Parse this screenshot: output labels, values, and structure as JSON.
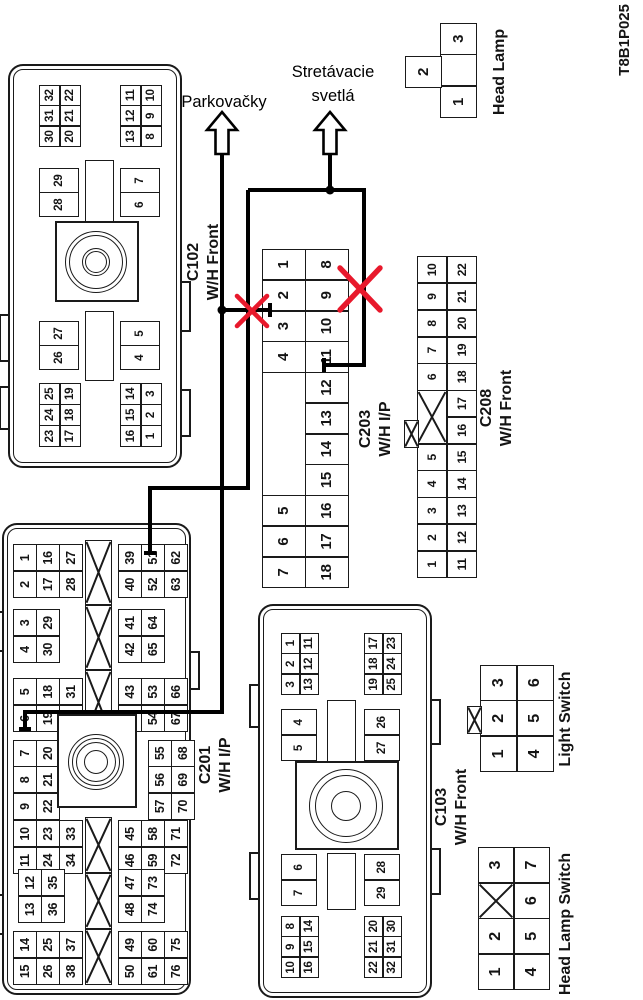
{
  "page": {
    "code": "T8B1P025",
    "background": "#ffffff",
    "ink": "#1a1a1a",
    "red": "#e8192c"
  },
  "overlay": {
    "labels": [
      {
        "id": "parkovacky",
        "lines": [
          "Parkovačky"
        ]
      },
      {
        "id": "stretavacie",
        "lines": [
          "Stretávacie",
          "svetlá"
        ]
      }
    ],
    "red_cross_count": 2,
    "arrow_icon": "up-arrow",
    "wire_targets": [
      "C203 pin 2",
      "C203 pin 11",
      "C201 pin 51",
      "C201 pin 7"
    ]
  },
  "connectors": {
    "c102": {
      "title": "C102",
      "subtitle": "W/H Front",
      "grids": [
        {
          "rows": [
            [
              "30",
              "31",
              "32"
            ],
            [
              "20",
              "21",
              "22"
            ]
          ]
        },
        {
          "rows": [
            [
              "13",
              "12",
              "11"
            ],
            [
              "8",
              "9",
              "10"
            ]
          ]
        },
        {
          "rows": [
            [
              "23",
              "24",
              "25"
            ],
            [
              "17",
              "18",
              "19"
            ]
          ]
        },
        {
          "rows": [
            [
              "16",
              "15",
              "14"
            ],
            [
              "1",
              "2",
              "3"
            ]
          ]
        },
        {
          "rows": [
            [
              "28",
              "29"
            ]
          ]
        },
        {
          "rows": [
            [
              "26",
              "27"
            ]
          ]
        },
        {
          "rows": [
            [
              "6",
              "7"
            ]
          ]
        },
        {
          "rows": [
            [
              "4",
              "5"
            ]
          ]
        }
      ]
    },
    "c201": {
      "title": "C201",
      "subtitle": "W/H I/P",
      "grids": [
        {
          "rows": [
            [
              "2",
              "1"
            ],
            [
              "17",
              "16"
            ],
            [
              "28",
              "27"
            ]
          ]
        },
        {
          "rows": [
            [
              "4",
              "3"
            ],
            [
              "30",
              "29"
            ]
          ]
        },
        {
          "rows": [
            [
              "6",
              "5"
            ],
            [
              "19",
              "18"
            ],
            [
              "32",
              "31"
            ]
          ]
        },
        {
          "rows": [
            [
              "9",
              "8",
              "7"
            ],
            [
              "22",
              "21",
              "20"
            ]
          ]
        },
        {
          "rows": [
            [
              "57",
              "56",
              "55"
            ],
            [
              "70",
              "69",
              "68"
            ]
          ]
        },
        {
          "rows": [
            [
              "40",
              "39"
            ],
            [
              "52",
              "51"
            ],
            [
              "63",
              "62"
            ]
          ]
        },
        {
          "rows": [
            [
              "42",
              "41"
            ],
            [
              "65",
              "64"
            ]
          ]
        },
        {
          "rows": [
            [
              "44",
              "43"
            ],
            [
              "54",
              "53"
            ],
            [
              "67",
              "66"
            ]
          ]
        },
        {
          "rows": [
            [
              "11",
              "10"
            ],
            [
              "24",
              "23"
            ],
            [
              "34",
              "33"
            ]
          ]
        },
        {
          "rows": [
            [
              "13",
              "12"
            ],
            [
              "36",
              "35"
            ]
          ]
        },
        {
          "rows": [
            [
              "15",
              "14"
            ],
            [
              "26",
              "25"
            ],
            [
              "38",
              "37"
            ]
          ]
        },
        {
          "rows": [
            [
              "46",
              "45"
            ],
            [
              "59",
              "58"
            ],
            [
              "72",
              "71"
            ]
          ]
        },
        {
          "rows": [
            [
              "48",
              "47"
            ],
            [
              "74",
              "73"
            ]
          ]
        },
        {
          "rows": [
            [
              "50",
              "49"
            ],
            [
              "61",
              "60"
            ],
            [
              "76",
              "75"
            ]
          ]
        }
      ]
    },
    "c203": {
      "title": "C203",
      "subtitle": "W/H I/P",
      "rows": [
        [
          "7",
          "6",
          "5",
          {
            "span": 4,
            "v": ""
          },
          "4",
          "3",
          "2",
          "1"
        ],
        [
          "18",
          "17",
          "16",
          "15",
          "14",
          "13",
          "12",
          "11",
          "10",
          "9",
          "8"
        ]
      ]
    },
    "c208": {
      "title": "C208",
      "subtitle": "W/H Front",
      "rows": [
        [
          "1",
          "2",
          "3",
          "4",
          "5",
          {
            "span": 2,
            "x": true
          },
          "6",
          "7",
          "8",
          "9",
          "10"
        ],
        [
          "11",
          "12",
          "13",
          "14",
          "15",
          "16",
          "17",
          "18",
          "19",
          "20",
          "21",
          "22"
        ]
      ]
    },
    "c103": {
      "title": "C103",
      "subtitle": "W/H Front",
      "grids": [
        {
          "rows": [
            [
              "3",
              "2",
              "1"
            ],
            [
              "13",
              "12",
              "11"
            ]
          ]
        },
        {
          "rows": [
            [
              "19",
              "18",
              "17"
            ],
            [
              "25",
              "24",
              "23"
            ]
          ]
        },
        {
          "rows": [
            [
              "10",
              "9",
              "8"
            ],
            [
              "16",
              "15",
              "14"
            ]
          ]
        },
        {
          "rows": [
            [
              "22",
              "21",
              "20"
            ],
            [
              "32",
              "31",
              "30"
            ]
          ]
        },
        {
          "rows": [
            [
              "5",
              "4"
            ]
          ]
        },
        {
          "rows": [
            [
              "27",
              "26"
            ]
          ]
        },
        {
          "rows": [
            [
              "7",
              "6"
            ]
          ]
        },
        {
          "rows": [
            [
              "29",
              "28"
            ]
          ]
        }
      ]
    },
    "head_lamp": {
      "title": "Head Lamp",
      "row": [
        "1",
        "",
        "3"
      ],
      "offset_pin": "2"
    },
    "light_switch": {
      "title": "Light Switch",
      "rows": [
        [
          "1",
          "2",
          "3"
        ],
        [
          "4",
          "5",
          "6"
        ]
      ]
    },
    "head_lamp_switch": {
      "title": "Head Lamp Switch",
      "rows": [
        [
          "1",
          "2",
          {
            "x": true
          },
          "3"
        ],
        [
          "4",
          "5",
          "6",
          "7"
        ]
      ]
    }
  }
}
